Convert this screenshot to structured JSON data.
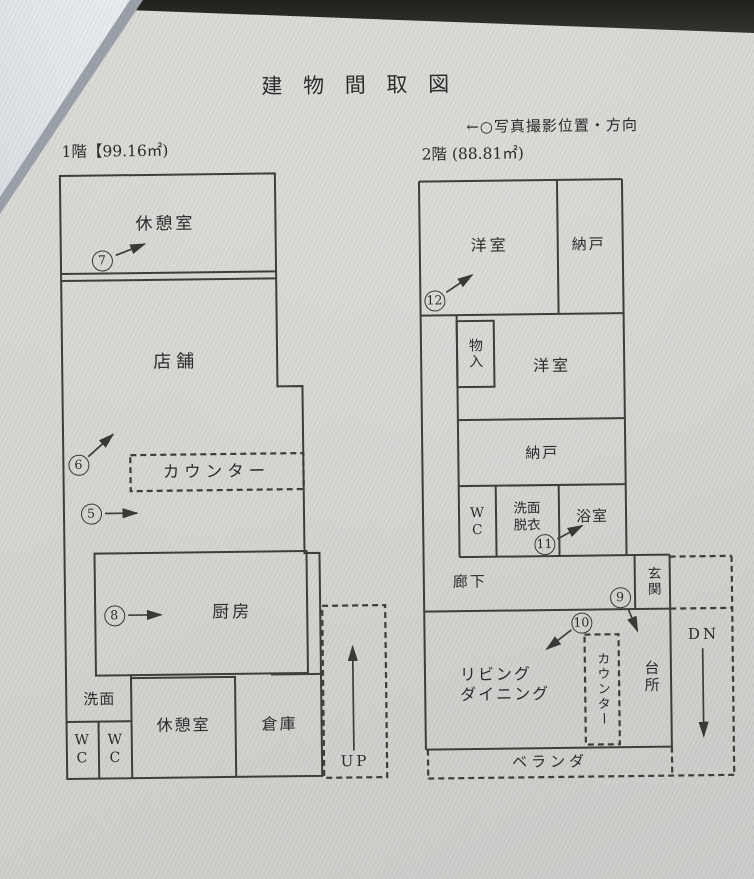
{
  "document": {
    "title": "建 物 間 取 図",
    "legend": "←○写真撮影位置・方向"
  },
  "floor1": {
    "heading": "1階【99.16㎡)",
    "labels": {
      "break_room_top": "休憩室",
      "shop": "店舗",
      "counter": "カウンター",
      "kitchen": "厨房",
      "washroom": "洗面",
      "wc_left": "W\nC",
      "wc_right": "W\nC",
      "break_room_bottom": "休憩室",
      "warehouse": "倉庫",
      "stairs": "UP"
    },
    "photo_markers": {
      "m5": "5",
      "m6": "6",
      "m7": "7",
      "m8": "8"
    }
  },
  "floor2": {
    "heading": "2階 (88.81㎡)",
    "labels": {
      "western_room_1": "洋室",
      "closet_1": "納戸",
      "storage_in": "物入",
      "western_room_2": "洋室",
      "closet_2": "納戸",
      "wc": "W\nC",
      "washroom_dressing": "洗面\n脱衣",
      "bathroom": "浴室",
      "hallway": "廊下",
      "entrance": "玄関",
      "living_dining": "リビング\nダイニング",
      "counter": "カウンター",
      "kitchen": "台所",
      "stairs": "DN",
      "veranda": "ベランダ"
    },
    "photo_markers": {
      "m9": "9",
      "m10": "10",
      "m11": "11",
      "m12": "12"
    }
  }
}
